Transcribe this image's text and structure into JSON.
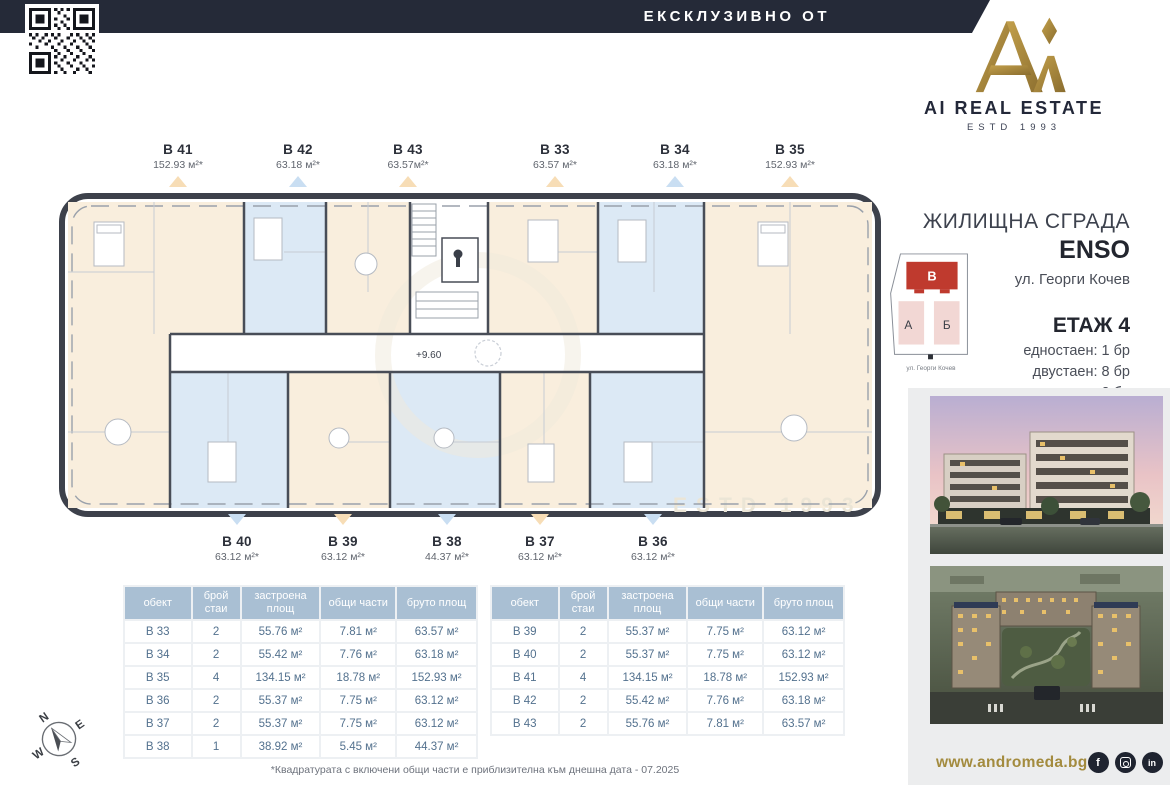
{
  "banner": {
    "label": "ЕКСКЛУЗИВНО ОТ"
  },
  "logo": {
    "name": "AI REAL ESTATE",
    "estd": "ESTD 1993"
  },
  "floorplan": {
    "level_mark": "+9.60",
    "watermark": "ESTD 1993",
    "top_units": [
      {
        "id": "В 41",
        "area": "152.93 м²*",
        "marker": "orange"
      },
      {
        "id": "В 42",
        "area": "63.18 м²*",
        "marker": "blue"
      },
      {
        "id": "В 43",
        "area": "63.57м²*",
        "marker": "orange"
      },
      {
        "id": "В 33",
        "area": "63.57 м²*",
        "marker": "orange"
      },
      {
        "id": "В 34",
        "area": "63.18 м²*",
        "marker": "blue"
      },
      {
        "id": "В 35",
        "area": "152.93 м²*",
        "marker": "orange"
      }
    ],
    "bottom_units": [
      {
        "id": "В 40",
        "area": "63.12 м²*",
        "marker": "blue"
      },
      {
        "id": "В 39",
        "area": "63.12 м²*",
        "marker": "orange"
      },
      {
        "id": "В 38",
        "area": "44.37 м²*",
        "marker": "blue"
      },
      {
        "id": "В 37",
        "area": "63.12 м²*",
        "marker": "orange"
      },
      {
        "id": "В 36",
        "area": "63.12 м²*",
        "marker": "blue"
      }
    ]
  },
  "info": {
    "building_type": "ЖИЛИЩНА СГРАДА",
    "building_name": "ENSO",
    "address": "ул. Георги Кочев",
    "floor": "ЕТАЖ 4",
    "mix": [
      "едностаен: 1 бр",
      "двустаен: 8 бр",
      "четиристаен: 2 бр"
    ],
    "siteplan": {
      "block_a": "А",
      "block_b": "Б",
      "block_v": "В",
      "street": "ул. Георги Кочев"
    }
  },
  "tables": {
    "headers": [
      "обект",
      "брой стаи",
      "застроена площ",
      "общи части",
      "бруто площ"
    ],
    "left_rows": [
      [
        "В 33",
        "2",
        "55.76 м²",
        "7.81 м²",
        "63.57 м²"
      ],
      [
        "В 34",
        "2",
        "55.42 м²",
        "7.76 м²",
        "63.18 м²"
      ],
      [
        "В 35",
        "4",
        "134.15 м²",
        "18.78 м²",
        "152.93 м²"
      ],
      [
        "В 36",
        "2",
        "55.37 м²",
        "7.75 м²",
        "63.12 м²"
      ],
      [
        "В 37",
        "2",
        "55.37 м²",
        "7.75 м²",
        "63.12 м²"
      ],
      [
        "В 38",
        "1",
        "38.92 м²",
        "5.45 м²",
        "44.37 м²"
      ]
    ],
    "right_rows": [
      [
        "В 39",
        "2",
        "55.37 м²",
        "7.75 м²",
        "63.12 м²"
      ],
      [
        "В 40",
        "2",
        "55.37 м²",
        "7.75 м²",
        "63.12 м²"
      ],
      [
        "В 41",
        "4",
        "134.15 м²",
        "18.78 м²",
        "152.93 м²"
      ],
      [
        "В 42",
        "2",
        "55.42 м²",
        "7.76 м²",
        "63.18 м²"
      ],
      [
        "В 43",
        "2",
        "55.76 м²",
        "7.81 м²",
        "63.57 м²"
      ]
    ]
  },
  "footnote": "*Квадратурата с включени общи части е приблизителна към днешна дата - 07.2025",
  "footer": {
    "website": "www.andromeda.bg",
    "socials": [
      "facebook",
      "instagram",
      "linkedin"
    ]
  },
  "compass": {
    "n": "N",
    "e": "E",
    "s": "S",
    "w": "W"
  },
  "colors": {
    "banner_navy": "#252a38",
    "accent_gold": "#a98b3f",
    "unit_cream": "#f9eedd",
    "unit_blue": "#dce9f5",
    "table_header": "#a9bfd3",
    "highlight_red": "#bf3a2e"
  }
}
